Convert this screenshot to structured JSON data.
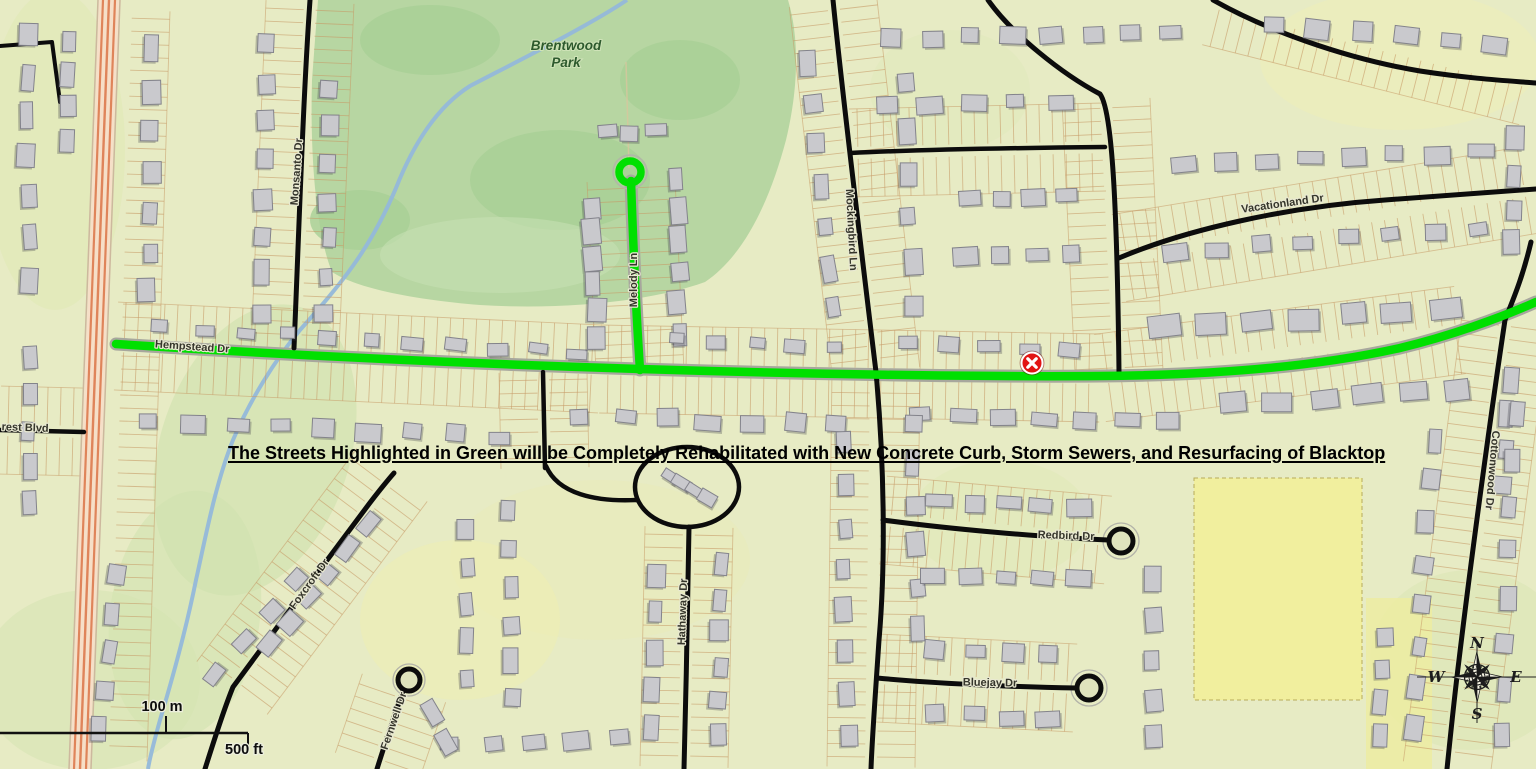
{
  "map": {
    "annotation": "The Streets Highlighted in Green will be Completely Rehabilitated with New Concrete Curb, Storm Sewers, and Resurfacing of Blacktop",
    "park": {
      "line1": "Brentwood",
      "line2": "Park"
    },
    "streets": {
      "hempstead": "Hempstead Dr",
      "melody": "Melody Ln",
      "monsanto": "Monsanto Dr",
      "mockingbird": "Mockingbird Ln",
      "vacationland": "Vacationland Dr",
      "cottonwood": "Cottonwood Dr",
      "redbird": "Redbird Dr",
      "bluejay": "Bluejay Dr",
      "foxcroft": "Foxcroft Dr",
      "fernwell": "Fernwell Dr",
      "hathaway": "Hathaway Dr",
      "rest_blvd": "rest Blvd"
    },
    "scalebar": {
      "metric": "100 m",
      "imperial": "500 ft"
    },
    "compass": {
      "north": "N",
      "east": "E",
      "south": "S",
      "west": "W"
    },
    "marker": {
      "kind": "red-x-marker"
    },
    "colors": {
      "highlight_green": "#00e000",
      "marker_red": "#e21414",
      "road_black": "#0c0c0c",
      "park_green": "#b7d6a2",
      "field_yellow": "#f2f09c",
      "background": "#e7ebc4",
      "stream_blue": "#93b8da",
      "highway_orange": "#dd7a4e"
    }
  }
}
